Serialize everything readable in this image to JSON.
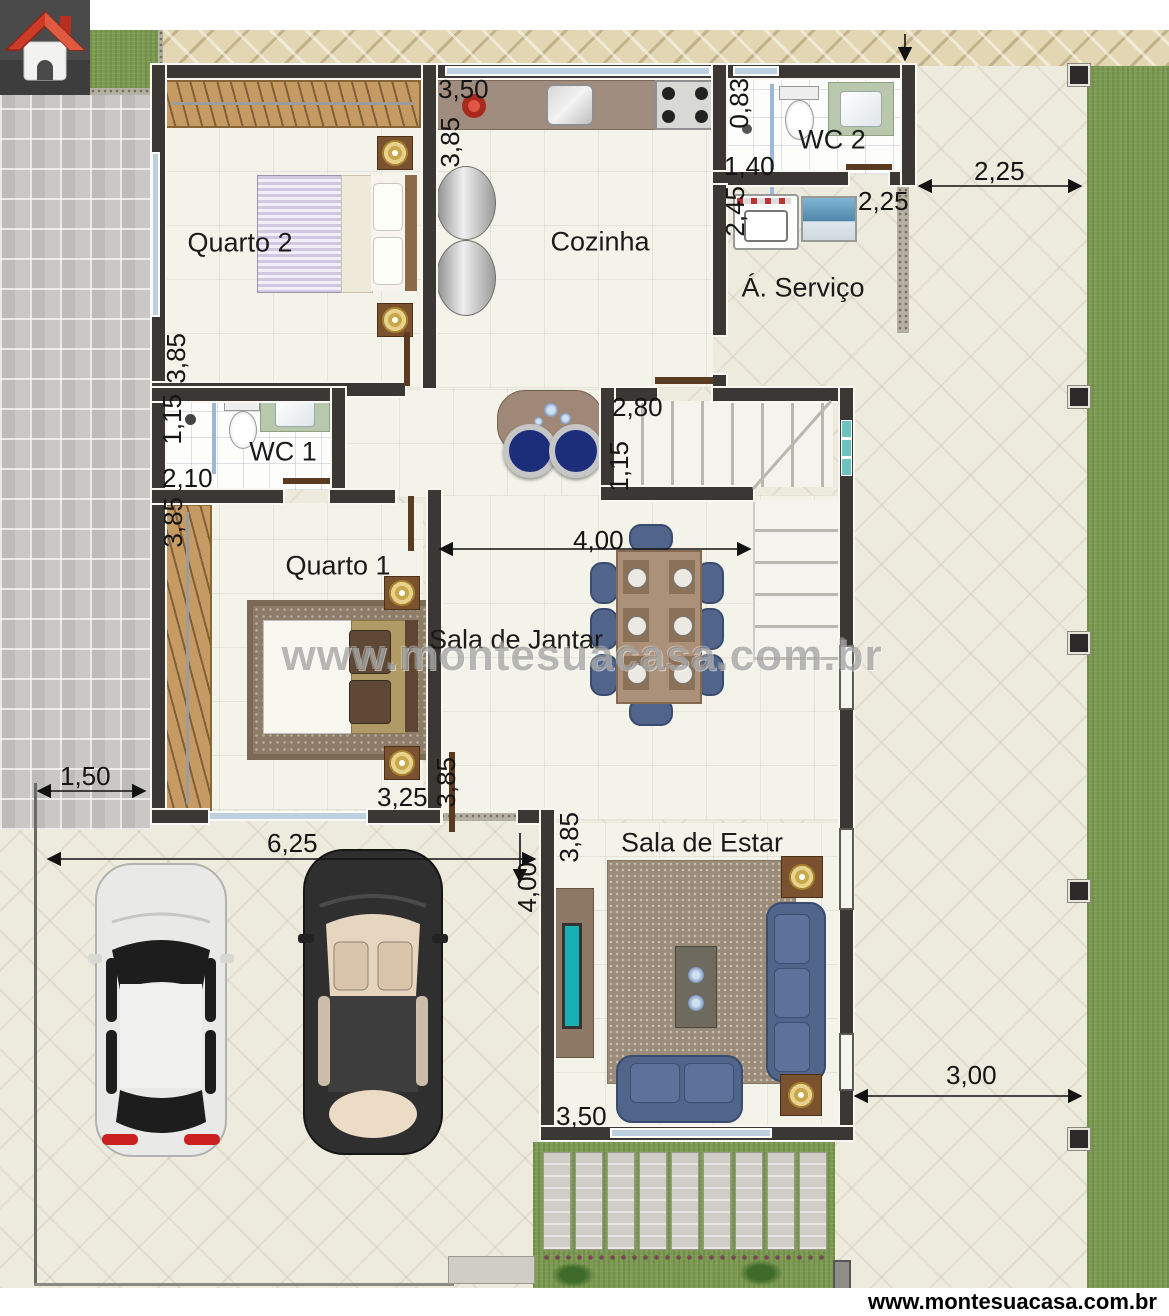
{
  "banner": {
    "url_text": "www.montesuacasa.com.br"
  },
  "watermark": {
    "text": "www.montesuacasa.com.br"
  },
  "rooms": {
    "quarto2": "Quarto 2",
    "cozinha": "Cozinha",
    "wc2": "WC 2",
    "servico": "Á. Serviço",
    "wc1": "WC 1",
    "quarto1": "Quarto 1",
    "jantar": "Sala de Jantar",
    "estar": "Sala de Estar"
  },
  "dims": {
    "kitchen_w": "3,50",
    "kitchen_h": "3,85",
    "wc2_h": "0,83",
    "wc2_w": "1,40",
    "wc2_door": "2,25",
    "right_top": "2,25",
    "servico_h": "2,45",
    "quarto2_h": "3,85",
    "wc1_h": "1,15",
    "wc1_w": "2,10",
    "stairs_w": "2,80",
    "stairs_h": "1,15",
    "quarto1_left_h": "3,85",
    "jantar_w": "4,00",
    "quarto1_w": "3,25",
    "quarto1_right_h": "3,85",
    "sidewalk_w": "1,50",
    "garage_w": "6,25",
    "garage_h": "4,00",
    "estar_left_h": "3,85",
    "estar_w": "3,50",
    "right_bottom": "3,00"
  },
  "colors": {
    "wall": "#3a3734",
    "grass": "#7c9a52",
    "glass_block": "#6cc4bf",
    "logo_roof_red": "#c03a2b",
    "sofa_navy": "#51648a",
    "wood": "#c59a63",
    "lamp_gold": "#c9a84c",
    "tv_teal": "#17b0b4"
  }
}
